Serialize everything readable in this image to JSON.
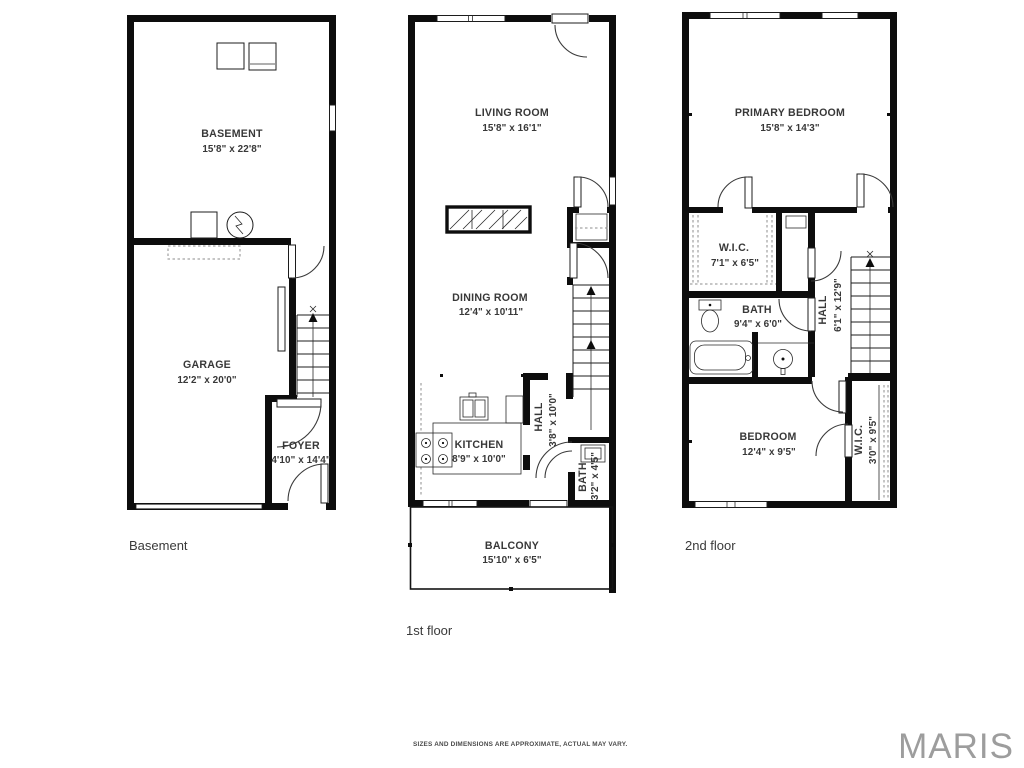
{
  "colors": {
    "wall": "#0d0d0d",
    "text": "#383838",
    "brand": "#9d9d9d"
  },
  "footer": {
    "disclaimer": "SIZES AND DIMENSIONS ARE APPROXIMATE, ACTUAL MAY VARY.",
    "brand": "MARIS"
  },
  "floors": [
    {
      "caption": "Basement",
      "rooms": [
        {
          "name": "BASEMENT",
          "dims": "15'8\" x 22'8\""
        },
        {
          "name": "GARAGE",
          "dims": "12'2\" x 20'0\""
        },
        {
          "name": "FOYER",
          "dims": "4'10\" x 14'4\""
        }
      ]
    },
    {
      "caption": "1st floor",
      "rooms": [
        {
          "name": "LIVING ROOM",
          "dims": "15'8\" x 16'1\""
        },
        {
          "name": "DINING ROOM",
          "dims": "12'4\" x 10'11\""
        },
        {
          "name": "KITCHEN",
          "dims": "8'9\" x 10'0\""
        },
        {
          "name": "HALL",
          "dims": "3'8\" x 10'0\""
        },
        {
          "name": "BATH",
          "dims": "3'2\" x 4'5\""
        },
        {
          "name": "BALCONY",
          "dims": "15'10\" x 6'5\""
        }
      ]
    },
    {
      "caption": "2nd floor",
      "rooms": [
        {
          "name": "PRIMARY BEDROOM",
          "dims": "15'8\" x 14'3\""
        },
        {
          "name": "W.I.C.",
          "dims": "7'1\" x 6'5\""
        },
        {
          "name": "BATH",
          "dims": "9'4\" x 6'0\""
        },
        {
          "name": "HALL",
          "dims": "6'1\" x 12'9\""
        },
        {
          "name": "BEDROOM",
          "dims": "12'4\" x 9'5\""
        },
        {
          "name": "W.I.C.",
          "dims": "3'0\" x 9'5\""
        }
      ]
    }
  ]
}
